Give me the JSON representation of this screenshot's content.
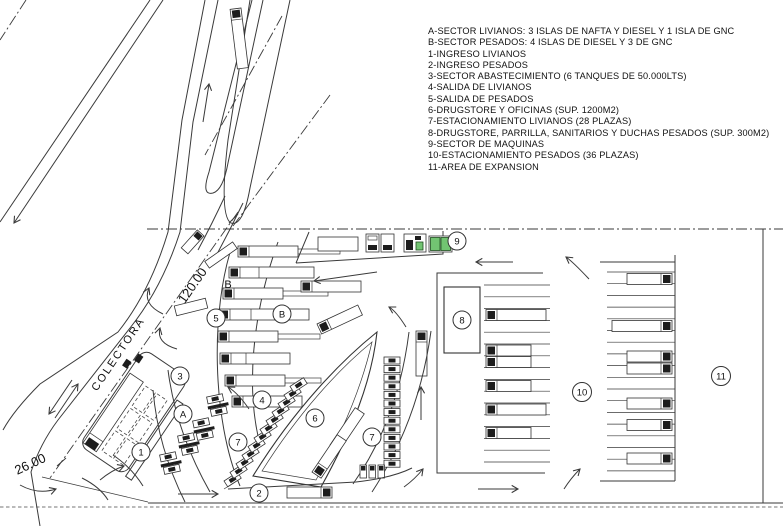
{
  "legend": {
    "items": [
      "A-SECTOR LIVIANOS: 3 ISLAS DE NAFTA Y DIESEL Y 1 ISLA DE GNC",
      "B-SECTOR PESADOS: 4 ISLAS DE DIESEL Y 3 DE GNC",
      "1-INGRESO LIVIANOS",
      "2-INGRESO PESADOS",
      "3-SECTOR ABASTECIMIENTO (6 TANQUES DE 50.000LTS)",
      "4-SALIDA DE LIVIANOS",
      "5-SALIDA DE PESADOS",
      "6-DRUGSTORE Y OFICINAS (SUP. 1200M2)",
      "7-ESTACIONAMIENTO LIVIANOS (28 PLAZAS)",
      "8-DRUGSTORE, PARRILLA, SANITARIOS Y DUCHAS PESADOS (SUP. 300M2)",
      "9-SECTOR DE MAQUINAS",
      "10-ESTACIONAMIENTO PESADOS (36 PLAZAS)",
      "11-AREA DE EXPANSION"
    ]
  },
  "plan": {
    "road_label": "COLECTORA",
    "dimensions": {
      "frontage": "120.00",
      "entry_width": "26.00"
    },
    "markers": {
      "sector_5": "5",
      "sector_b_text": "B",
      "sector_b": "B",
      "sector_3": "3",
      "sector_a": "A",
      "sector_1": "1",
      "sector_7_left": "7",
      "sector_4": "4",
      "sector_6": "6",
      "sector_7_right": "7",
      "sector_2": "2",
      "sector_9": "9",
      "sector_8": "8",
      "sector_10": "10",
      "sector_11": "11"
    },
    "colors": {
      "ink": "#3a3a3a",
      "machine_green": "#72c472"
    }
  }
}
